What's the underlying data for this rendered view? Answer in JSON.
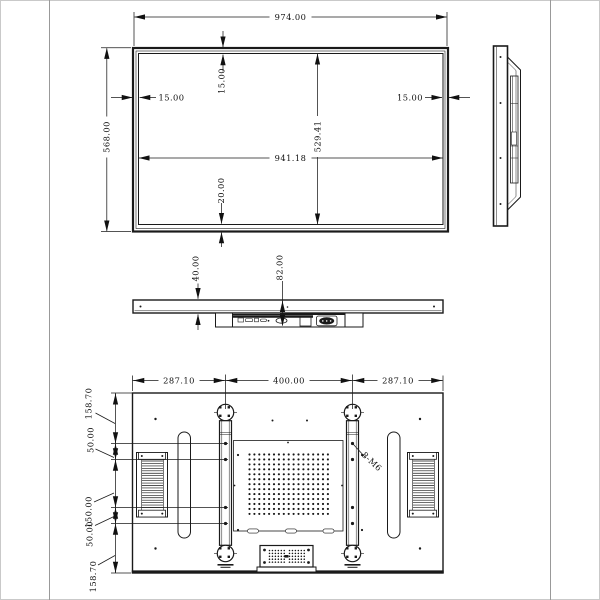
{
  "front": {
    "overall_width": "974.00",
    "overall_height": "568.00",
    "active_width": "941.18",
    "active_height": "529.41",
    "bezel_top": "15.00",
    "bezel_left": "15.00",
    "bezel_right": "15.00",
    "bezel_bottom": "20.00"
  },
  "profile": {
    "thickness": "40.00",
    "total_depth": "82.00"
  },
  "rear": {
    "span_left": "287.10",
    "vesa_width": "400.00",
    "span_right": "287.10",
    "margin_top": "158.70",
    "gap_upper": "50.00",
    "mid_span": "150.00",
    "gap_lower": "50.00",
    "margin_bottom": "158.70",
    "thread_callout": "8-M6"
  },
  "colors": {
    "ink": "#1a1a1a",
    "sheet_frame": "#999999",
    "background": "#ffffff"
  }
}
